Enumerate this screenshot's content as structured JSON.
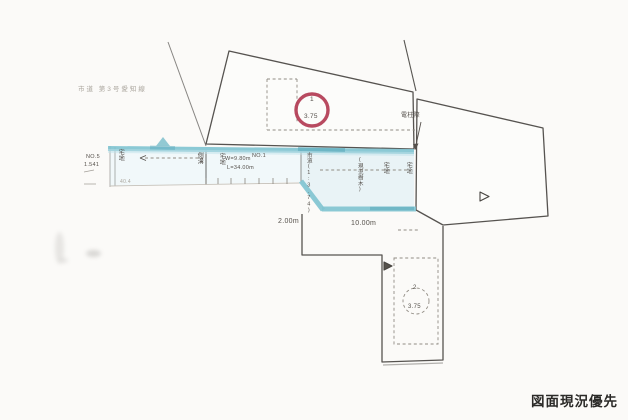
{
  "drawing": {
    "header_note": "市道 第3号愛知線",
    "stamp": "図面現況優先",
    "colors": {
      "road_highlight": "#7fc3d0",
      "lot_marker_red": "#b23b52"
    },
    "lots": [
      {
        "label": "1",
        "area": "3.75",
        "marker": "red-circle"
      },
      {
        "label": "2",
        "area": "3.75",
        "marker": "dashed-circle"
      }
    ],
    "dimensions": {
      "left_offset": "2.00m",
      "frontage": "10.00m",
      "road_width": "W=9.80m",
      "road_length": "L=34.00m"
    },
    "survey_points": {
      "no1": "NO.1",
      "no5": "NO.5",
      "bench": "1.541",
      "spot": "40.4"
    },
    "annotations": {
      "pole": "電柱際",
      "road_col_left": "宅地",
      "road_col_gutter": "側溝",
      "road_col_mid": "宅地",
      "road_col_scale": "市道(1:3.74)",
      "road_col_note": "(現況樹木)",
      "road_col_r1": "宅地",
      "road_col_r2": "宅地"
    }
  }
}
